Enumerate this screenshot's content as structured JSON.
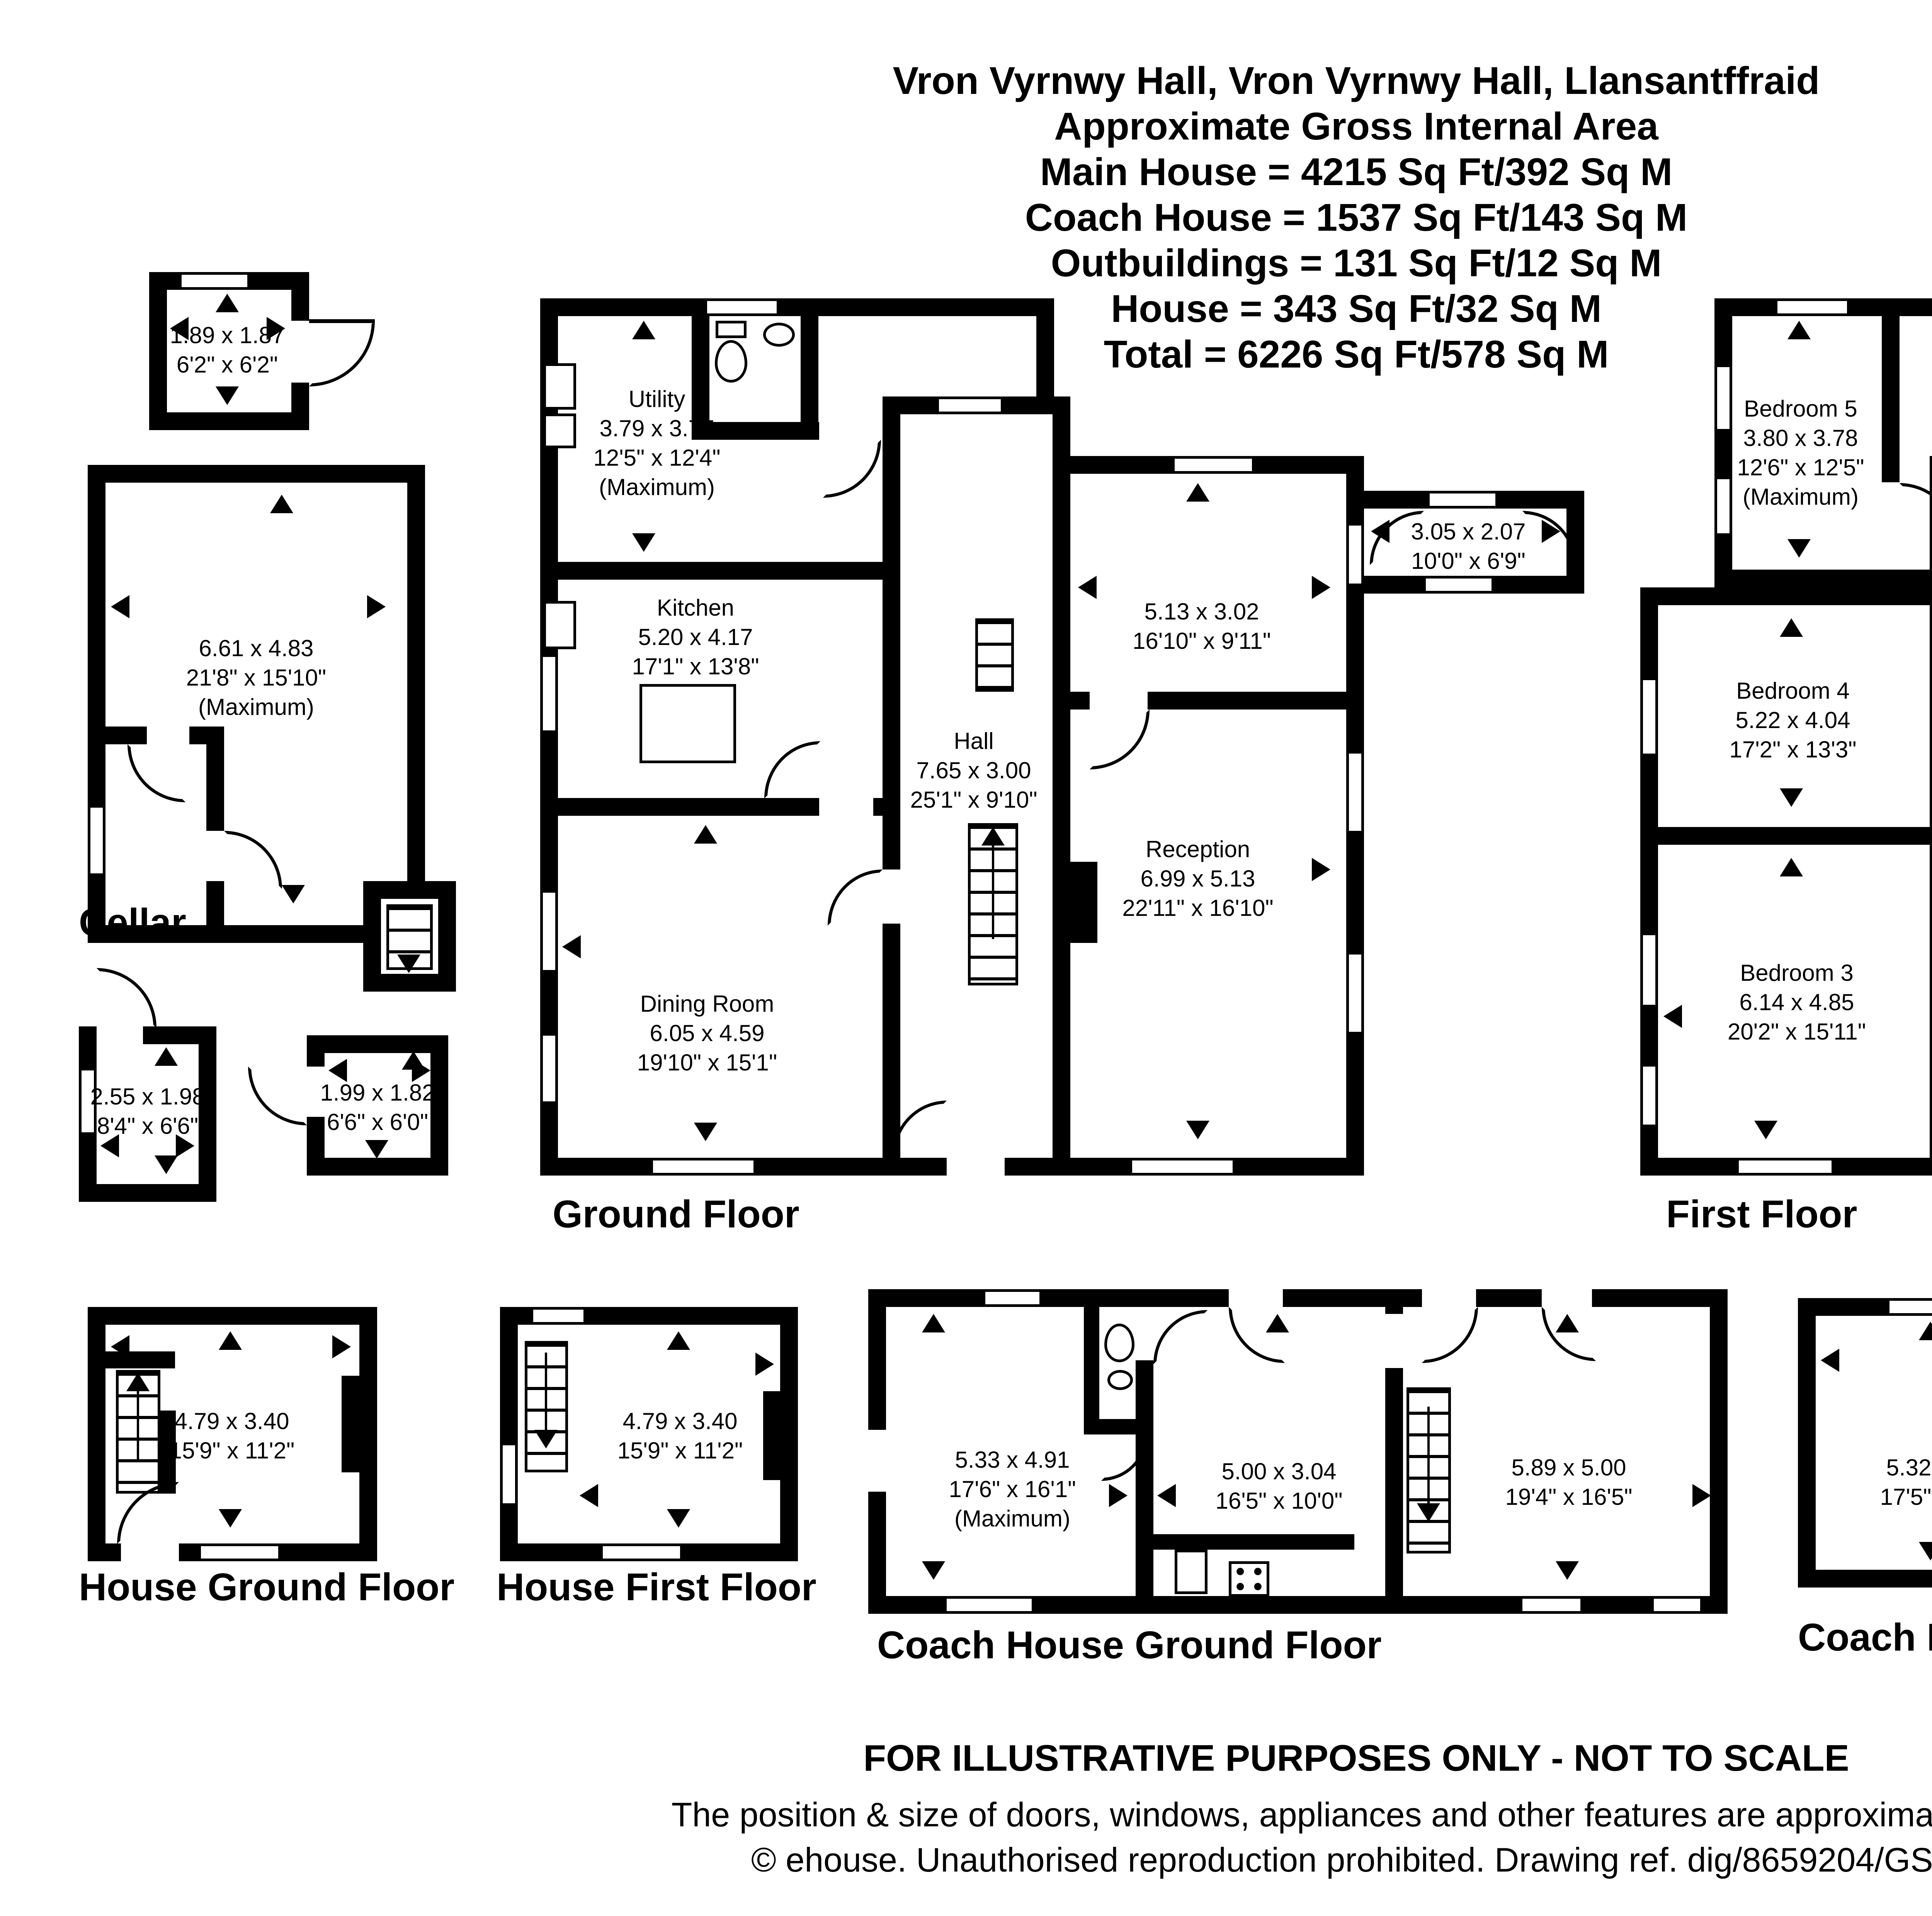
{
  "title": {
    "lines": [
      "Vron Vyrnwy Hall, Vron Vyrnwy Hall, Llansantffraid",
      "Approximate Gross Internal Area",
      "Main House = 4215 Sq Ft/392 Sq M",
      "Coach House = 1537 Sq Ft/143 Sq M",
      "Outbuildings = 131 Sq Ft/12 Sq M",
      "House = 343 Sq Ft/32 Sq M",
      "Total = 6226 Sq Ft/578 Sq M"
    ]
  },
  "compass": {
    "north": "N",
    "east": "E",
    "south": "S",
    "west": "W"
  },
  "floor_labels": {
    "cellar": "Cellar",
    "ground": "Ground Floor",
    "first": "First Floor",
    "house_ground": "House Ground Floor",
    "house_first": "House First Floor",
    "coach_ground": "Coach House Ground Floor",
    "coach_first": "Coach House First Floor"
  },
  "rooms": {
    "outbuilding_top": {
      "metric": "1.89 x 1.87",
      "imperial": "6'2\" x 6'2\""
    },
    "cellar_main": {
      "metric": "6.61 x 4.83",
      "imperial": "21'8\" x 15'10\"",
      "note": "(Maximum)"
    },
    "outbuilding_a": {
      "metric": "2.55 x 1.98",
      "imperial": "8'4\" x 6'6\""
    },
    "outbuilding_b": {
      "metric": "1.99 x 1.82",
      "imperial": "6'6\" x 6'0\""
    },
    "utility": {
      "name": "Utility",
      "metric": "3.79 x 3.77",
      "imperial": "12'5\" x 12'4\"",
      "note": "(Maximum)"
    },
    "kitchen": {
      "name": "Kitchen",
      "metric": "5.20 x 4.17",
      "imperial": "17'1\" x 13'8\""
    },
    "hall": {
      "name": "Hall",
      "metric": "7.65 x 3.00",
      "imperial": "25'1\" x 9'10\""
    },
    "dining": {
      "name": "Dining Room",
      "metric": "6.05 x 4.59",
      "imperial": "19'10\" x 15'1\""
    },
    "gf_room": {
      "metric": "5.13 x 3.02",
      "imperial": "16'10\" x 9'11\""
    },
    "reception": {
      "name": "Reception",
      "metric": "6.99 x 5.13",
      "imperial": "22'11\" x 16'10\""
    },
    "porch": {
      "metric": "3.05 x 2.07",
      "imperial": "10'0\" x 6'9\""
    },
    "bedroom5": {
      "name": "Bedroom 5",
      "metric": "3.80 x 3.78",
      "imperial": "12'6\" x 12'5\"",
      "note": "(Maximum)"
    },
    "bedroom4": {
      "name": "Bedroom 4",
      "metric": "5.22 x 4.04",
      "imperial": "17'2\" x 13'3\""
    },
    "bedroom3": {
      "name": "Bedroom 3",
      "metric": "6.14 x 4.85",
      "imperial": "20'2\" x 15'11\""
    },
    "landing": {
      "metric": "9.17 x 3.07",
      "imperial": "30'1\" x 10'1\""
    },
    "bedroom1": {
      "name": "Bedroom 1",
      "metric": "5.58 x 4.33",
      "imperial": "18'4\" x 14'2\"",
      "note": "(Maximum)"
    },
    "ff_room": {
      "metric": "5.20 x 2.05",
      "imperial": "17'1\" x 6'9\""
    },
    "bedroom2": {
      "name": "Bedroom 2",
      "metric": "5.15 x 4.98",
      "imperial": "16'11\" x 16'4\""
    },
    "house_gf": {
      "metric": "4.79 x 3.40",
      "imperial": "15'9\" x 11'2\""
    },
    "house_ff": {
      "metric": "4.79 x 3.40",
      "imperial": "15'9\" x 11'2\""
    },
    "coach_gf_left": {
      "metric": "5.33 x 4.91",
      "imperial": "17'6\" x 16'1\"",
      "note": "(Maximum)"
    },
    "coach_gf_mid": {
      "metric": "5.00 x 3.04",
      "imperial": "16'5\" x 10'0\""
    },
    "coach_gf_right": {
      "metric": "5.89 x 5.00",
      "imperial": "19'4\" x 16'5\""
    },
    "coach_ff_left": {
      "metric": "5.32 x 4.92",
      "imperial": "17'5\" x 16'2\""
    },
    "coach_ff_mid": {
      "metric": "4.92 x 3.04",
      "imperial": "16'2\" x 10'0\""
    },
    "coach_ff_right": {
      "metric": "5.89 x 4.92",
      "imperial": "19'4\" x 16'2\""
    }
  },
  "footer": {
    "line1": "FOR ILLUSTRATIVE PURPOSES ONLY - NOT TO SCALE",
    "line2": "The position & size of doors, windows, appliances and other features are approximate only.",
    "line3": "© ehouse. Unauthorised reproduction prohibited. Drawing ref. dig/8659204/GSM"
  },
  "colors": {
    "wall": "#000000",
    "background": "#ffffff"
  }
}
